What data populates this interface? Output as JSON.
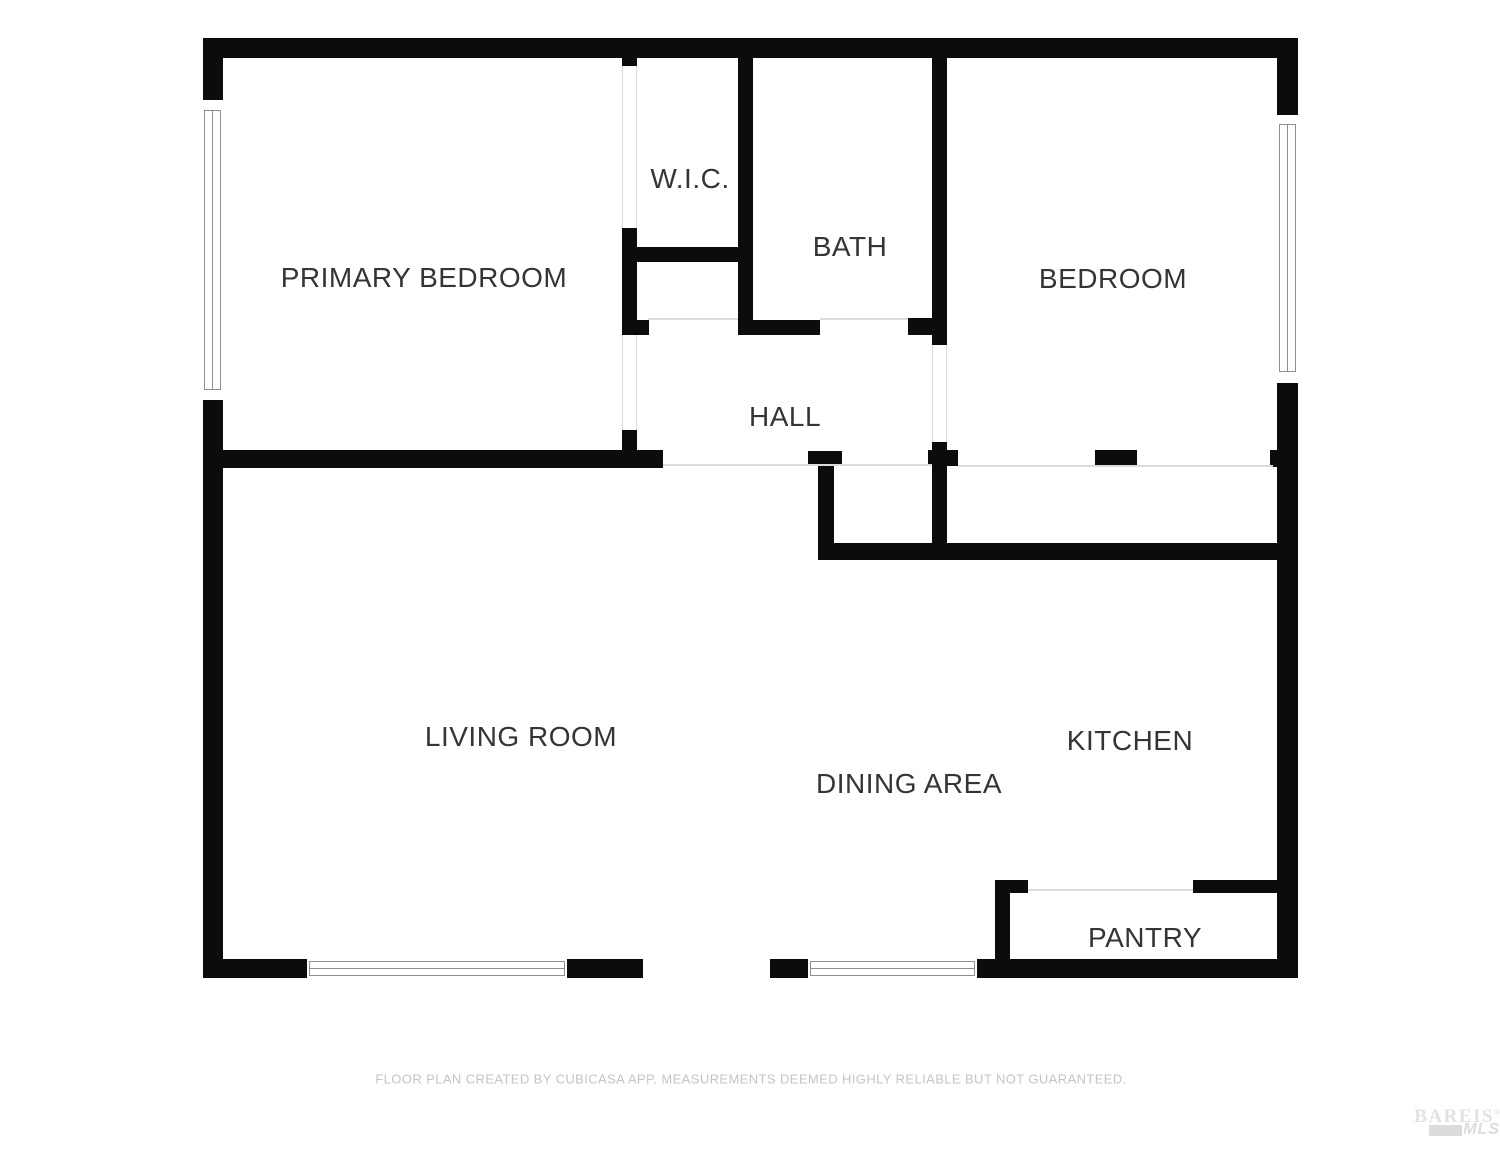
{
  "floor_plan": {
    "rooms": [
      {
        "id": "primary-bedroom",
        "label": "PRIMARY BEDROOM"
      },
      {
        "id": "wic",
        "label": "W.I.C."
      },
      {
        "id": "bath",
        "label": "BATH"
      },
      {
        "id": "bedroom",
        "label": "BEDROOM"
      },
      {
        "id": "hall",
        "label": "HALL"
      },
      {
        "id": "living-room",
        "label": "LIVING ROOM"
      },
      {
        "id": "dining-area",
        "label": "DINING AREA"
      },
      {
        "id": "kitchen",
        "label": "KITCHEN"
      },
      {
        "id": "pantry",
        "label": "PANTRY"
      }
    ],
    "footer_disclaimer": "FLOOR PLAN CREATED BY CUBICASA APP. MEASUREMENTS DEEMED HIGHLY RELIABLE BUT NOT GUARANTEED.",
    "watermark": {
      "brand": "BAREIS",
      "registered_mark": "®",
      "sub_brand": "MLS"
    },
    "colors": {
      "wall": "#0c0c0c",
      "room_label": "#353535",
      "opening_line": "#dadcdc",
      "window_frame": "#8f8f8f",
      "footer_text": "#c4c4c4",
      "watermark_text": "#e2e2e2"
    }
  }
}
